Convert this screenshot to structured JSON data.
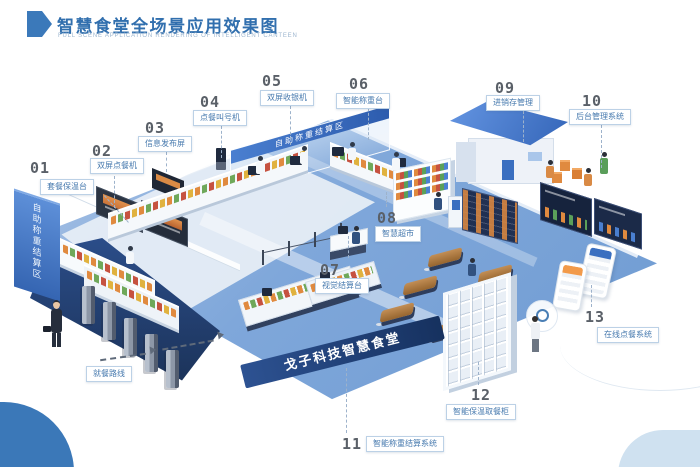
{
  "header": {
    "title": "智慧食堂全场景应用效果图",
    "subtitle": "FULL SCENE APPLICATION RENDERING OF INTELLIGENT CANTEEN"
  },
  "colors": {
    "accent_blue": "#3b79ba",
    "title_blue": "#316fae",
    "callout_text_blue": "#4679ae",
    "floor_blue": "#7fa7da",
    "navy": "#1f3a66",
    "roof_blue": "#3a6fc0",
    "food_orange": "#e08a3f"
  },
  "callouts": [
    {
      "number": "01",
      "label": "套餐保温台"
    },
    {
      "number": "02",
      "label": "双屏点餐机"
    },
    {
      "number": "03",
      "label": "信息发布屏"
    },
    {
      "number": "04",
      "label": "点餐叫号机"
    },
    {
      "number": "05",
      "label": "双屏收银机"
    },
    {
      "number": "06",
      "label": "智能称重台"
    },
    {
      "number": "07",
      "label": "视觉结算台"
    },
    {
      "number": "08",
      "label": "智慧超市"
    },
    {
      "number": "09",
      "label": "进销存管理"
    },
    {
      "number": "10",
      "label": "后台管理系统"
    },
    {
      "number": "11",
      "label": "智能称重结算系统"
    },
    {
      "number": "12",
      "label": "智能保温取餐柜"
    },
    {
      "number": "13",
      "label": "在线点餐系统"
    }
  ],
  "scene": {
    "zone_banner": "自助称重结算区",
    "wall_text": "自助称重结算区",
    "floor_brand": "戈子科技智慧食堂",
    "route_label": "就餐路线"
  }
}
